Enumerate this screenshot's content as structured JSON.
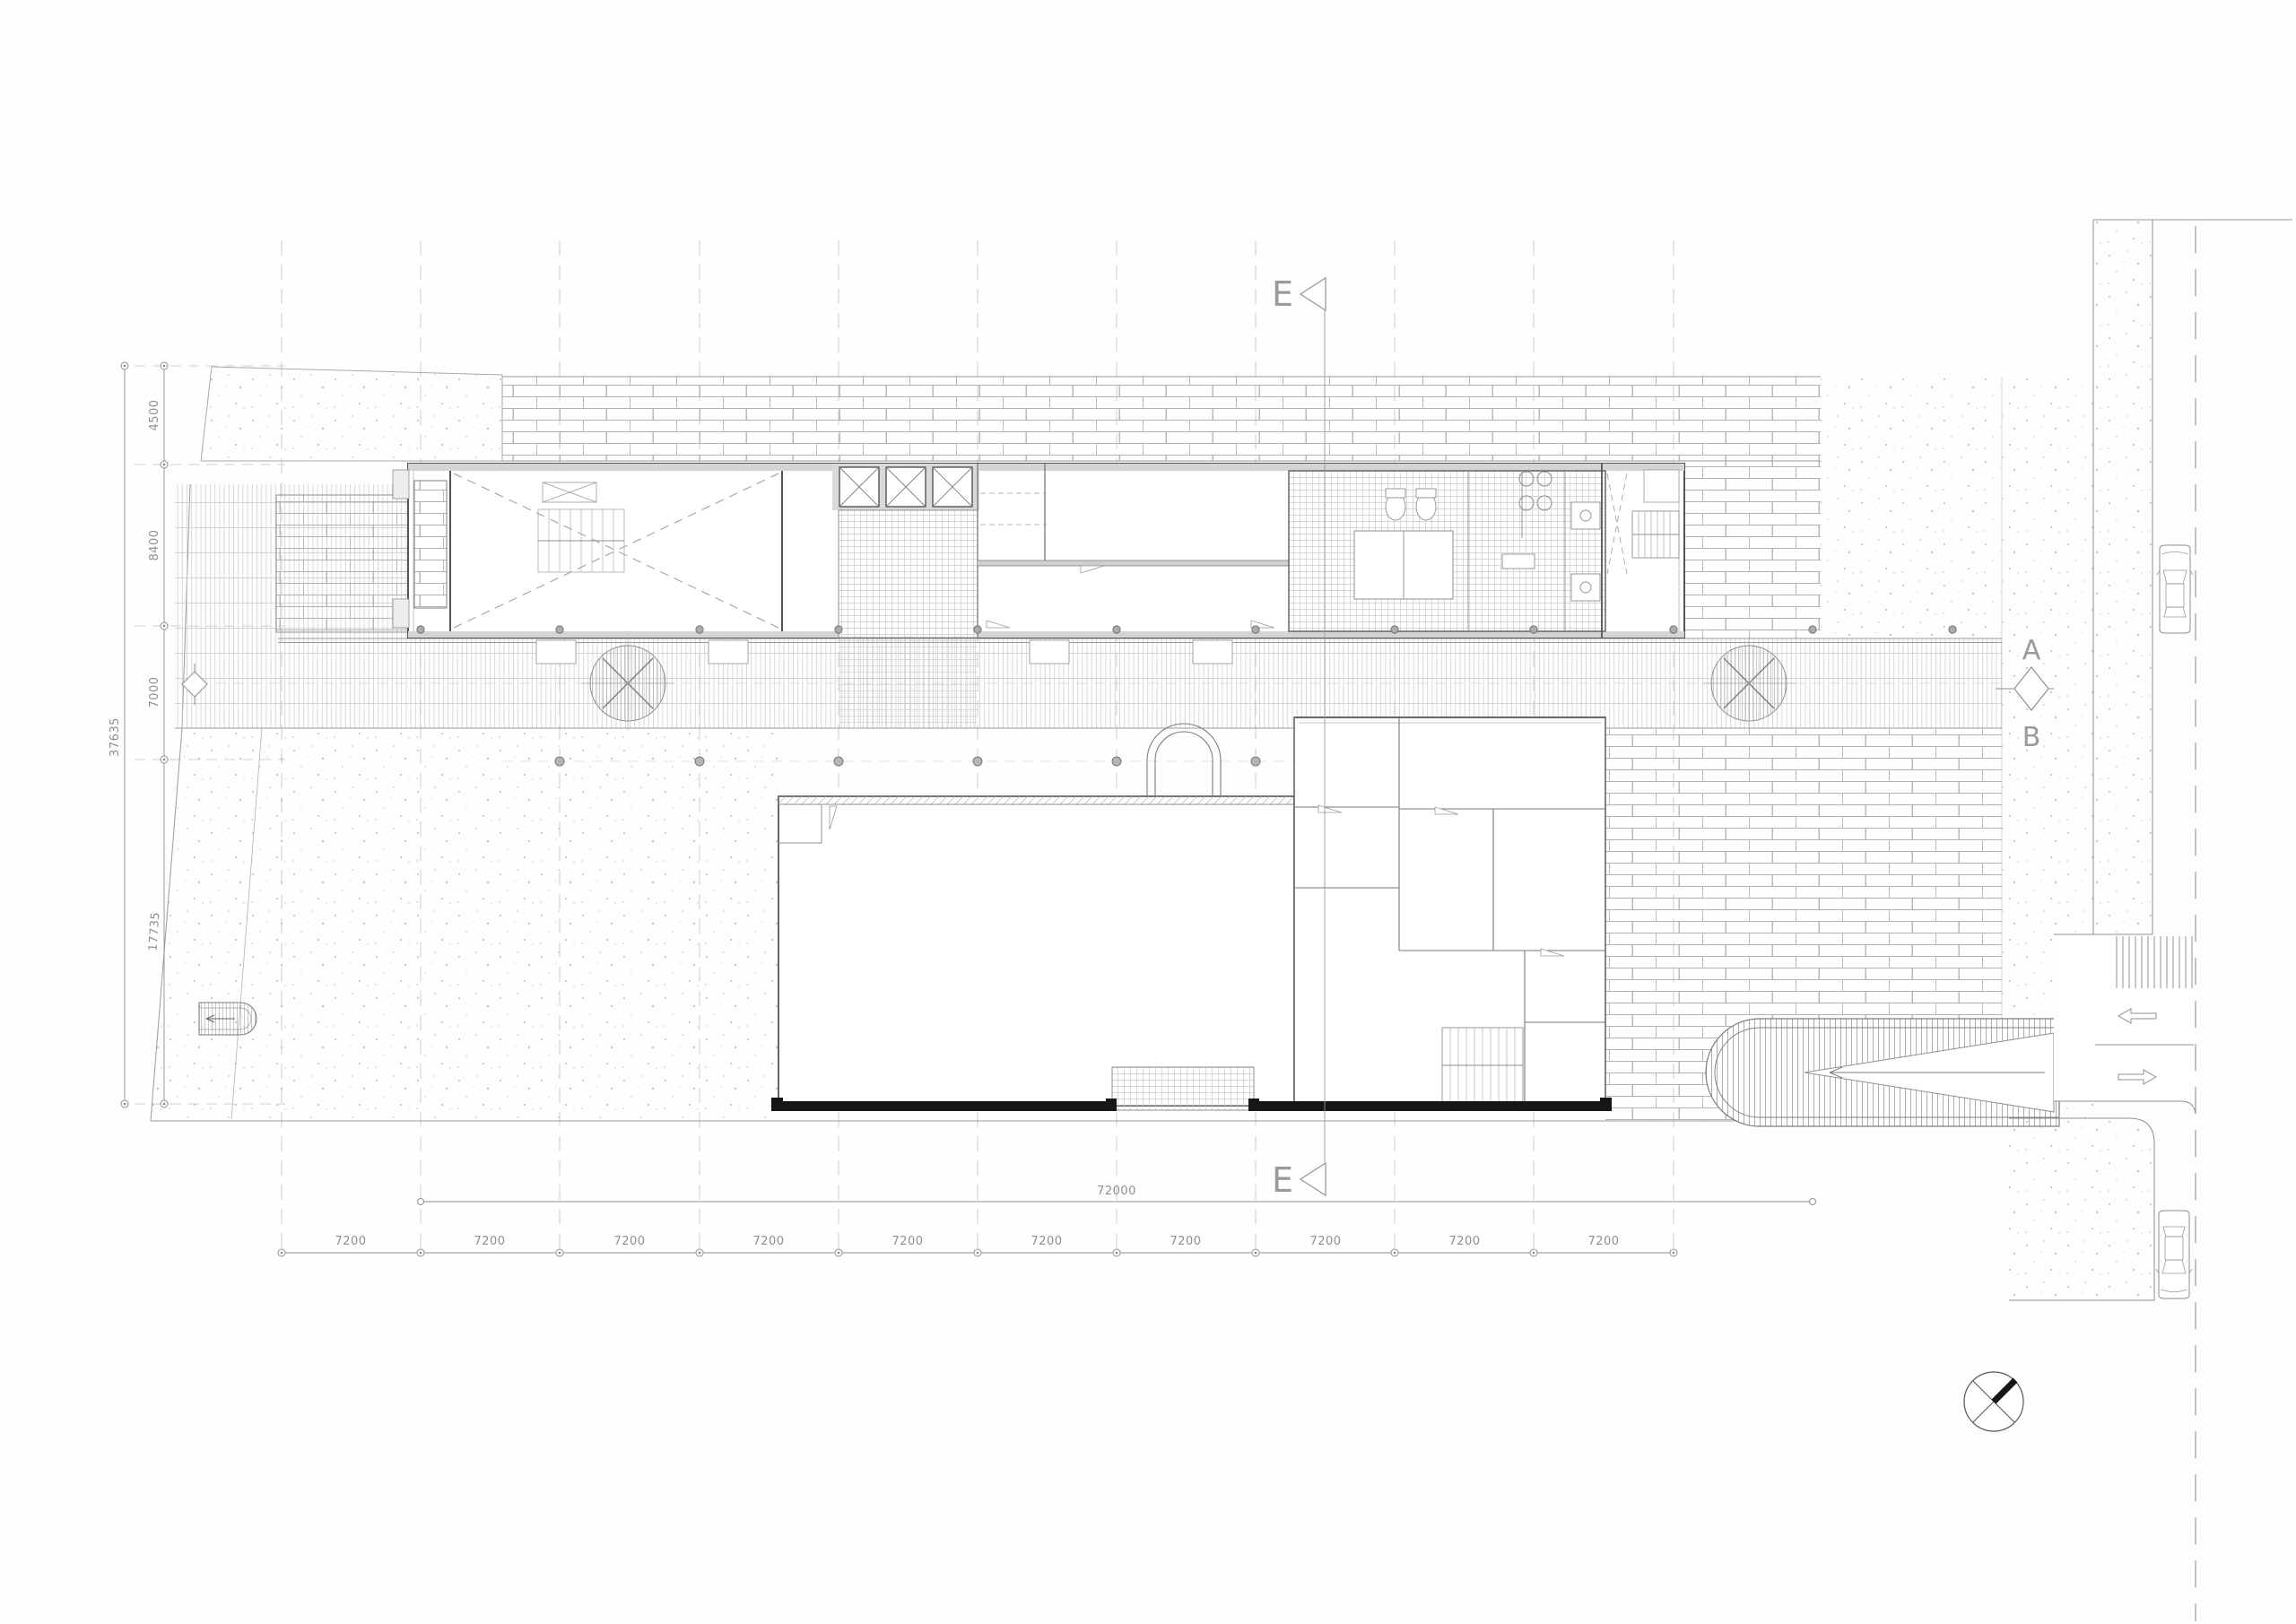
{
  "drawing": {
    "markers": {
      "section_top": "E",
      "section_bottom": "E",
      "section_a": "A",
      "section_b": "B"
    },
    "dims": {
      "left": {
        "total": "37635",
        "bays": [
          "4500",
          "8400",
          "7000",
          "17735"
        ]
      },
      "bottom": {
        "total": "72000",
        "bays": [
          "7200",
          "7200",
          "7200",
          "7200",
          "7200",
          "7200",
          "7200",
          "7200",
          "7200",
          "7200"
        ]
      }
    },
    "colors": {
      "paper": "#fefefe",
      "line_light": "#bcbcbc",
      "line_mid": "#8f8f8f",
      "wall_dark": "#555555",
      "wall_black": "#161616"
    }
  }
}
